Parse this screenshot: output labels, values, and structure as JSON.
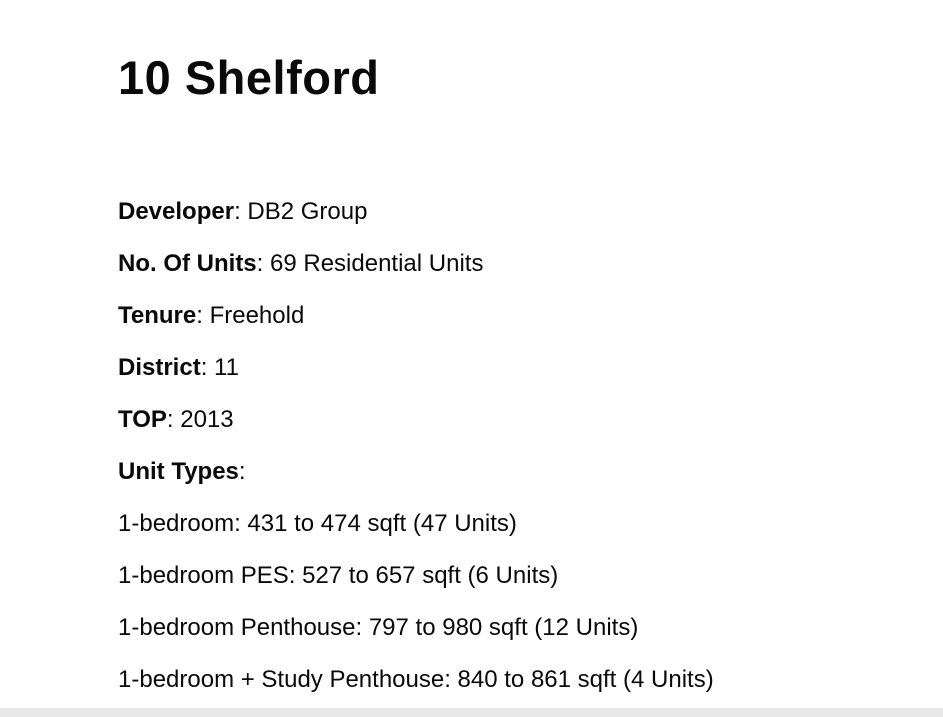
{
  "colors": {
    "background": "#ffffff",
    "text": "#0a0a0a",
    "footer_bar": "#e8e8e8"
  },
  "page": {
    "title": "10 Shelford",
    "separator": ": ",
    "details": [
      {
        "label": "Developer",
        "value": "DB2 Group"
      },
      {
        "label": "No. Of Units",
        "value": "69 Residential Units"
      },
      {
        "label": "Tenure",
        "value": "Freehold"
      },
      {
        "label": "District",
        "value": "11"
      },
      {
        "label": "TOP",
        "value": "2013"
      },
      {
        "label": "Unit Types",
        "value": ""
      }
    ],
    "unit_types": [
      "1-bedroom: 431 to 474 sqft (47 Units)",
      "1-bedroom PES: 527 to 657 sqft (6 Units)",
      "1-bedroom Penthouse: 797 to 980 sqft (12 Units)",
      "1-bedroom + Study Penthouse: 840 to 861 sqft (4 Units)"
    ]
  }
}
